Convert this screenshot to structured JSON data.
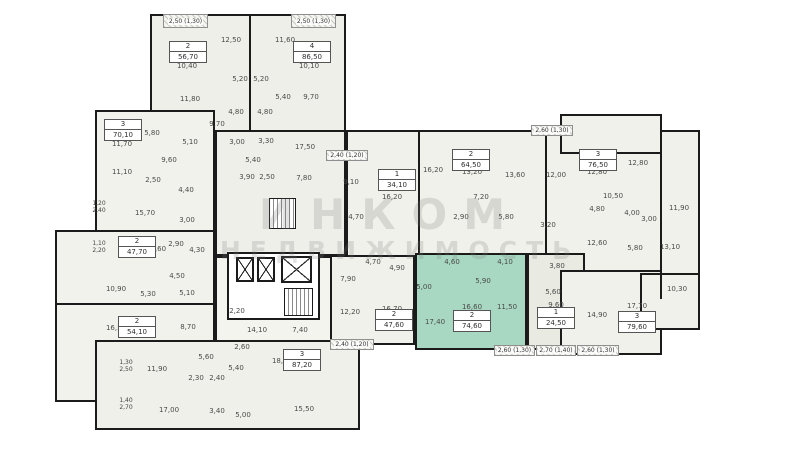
{
  "watermark": {
    "line1": "ИНКОМ",
    "line2": "НЕДВИЖИМОСТЬ"
  },
  "colors": {
    "wall": "#1b1b1b",
    "room_fill": "#f1f1eb",
    "highlight_fill": "#a8d8c2",
    "secondary_fill": "#e9eae2",
    "background": "#ffffff"
  },
  "blocks": [
    {
      "name": "tower-top",
      "x": 150,
      "y": 14,
      "w": 196,
      "h": 120,
      "fill": "#efefe9"
    },
    {
      "name": "tower-mid",
      "x": 215,
      "y": 130,
      "w": 131,
      "h": 126,
      "fill": "#efefe9"
    },
    {
      "name": "left-wing-top",
      "x": 95,
      "y": 110,
      "w": 120,
      "h": 122,
      "fill": "#f2f2ec"
    },
    {
      "name": "left-wing-main",
      "x": 55,
      "y": 230,
      "w": 160,
      "h": 172,
      "fill": "#f2f2ec"
    },
    {
      "name": "corridor-block",
      "x": 215,
      "y": 256,
      "w": 145,
      "h": 89,
      "fill": "#f4f4ef"
    },
    {
      "name": "bottom-block",
      "x": 95,
      "y": 340,
      "w": 265,
      "h": 90,
      "fill": "#eff0e9"
    },
    {
      "name": "mid-band",
      "x": 346,
      "y": 130,
      "w": 354,
      "h": 170,
      "fill": "#f1f1eb"
    },
    {
      "name": "right-top-block",
      "x": 560,
      "y": 114,
      "w": 102,
      "h": 40,
      "fill": "#f1f1eb"
    },
    {
      "name": "unit-4760-block",
      "x": 330,
      "y": 255,
      "w": 85,
      "h": 90,
      "fill": "#f1f1eb"
    },
    {
      "name": "unit-selected-block",
      "x": 415,
      "y": 253,
      "w": 112,
      "h": 97,
      "fill": "#a8d8c2"
    },
    {
      "name": "unit-2450-block",
      "x": 527,
      "y": 253,
      "w": 58,
      "h": 97,
      "fill": "#e9eae2"
    },
    {
      "name": "bottom-right-block",
      "x": 560,
      "y": 270,
      "w": 102,
      "h": 85,
      "fill": "#f1f1eb"
    },
    {
      "name": "bottom-right-protrusion",
      "x": 640,
      "y": 273,
      "w": 60,
      "h": 57,
      "fill": "#f1f1eb"
    },
    {
      "name": "core-block",
      "x": 227,
      "y": 252,
      "w": 93,
      "h": 68,
      "fill": "#ffffff"
    }
  ],
  "walls": [
    {
      "x": 249,
      "y": 14,
      "w": 2,
      "h": 118
    },
    {
      "x": 418,
      "y": 131,
      "w": 2,
      "h": 124
    },
    {
      "x": 545,
      "y": 131,
      "w": 2,
      "h": 124
    },
    {
      "x": 660,
      "y": 131,
      "w": 2,
      "h": 168
    },
    {
      "x": 57,
      "y": 303,
      "w": 158,
      "h": 2
    }
  ],
  "apartments": [
    {
      "rooms": "2",
      "area": "56,70",
      "x": 188,
      "y": 52,
      "selected": false
    },
    {
      "rooms": "4",
      "area": "86,50",
      "x": 312,
      "y": 52,
      "selected": false
    },
    {
      "rooms": "3",
      "area": "70,10",
      "x": 123,
      "y": 130,
      "selected": false
    },
    {
      "rooms": "2",
      "area": "47,70",
      "x": 137,
      "y": 247,
      "selected": false
    },
    {
      "rooms": "2",
      "area": "54,10",
      "x": 137,
      "y": 327,
      "selected": false
    },
    {
      "rooms": "3",
      "area": "87,20",
      "x": 302,
      "y": 360,
      "selected": false
    },
    {
      "rooms": "1",
      "area": "34,10",
      "x": 397,
      "y": 180,
      "selected": false
    },
    {
      "rooms": "2",
      "area": "64,50",
      "x": 471,
      "y": 160,
      "selected": false
    },
    {
      "rooms": "3",
      "area": "76,50",
      "x": 598,
      "y": 160,
      "selected": false
    },
    {
      "rooms": "2",
      "area": "47,60",
      "x": 394,
      "y": 320,
      "selected": false
    },
    {
      "rooms": "2",
      "area": "74,60",
      "x": 472,
      "y": 321,
      "selected": true
    },
    {
      "rooms": "1",
      "area": "24,50",
      "x": 556,
      "y": 318,
      "selected": false
    },
    {
      "rooms": "3",
      "area": "79,60",
      "x": 637,
      "y": 322,
      "selected": false
    }
  ],
  "rooms": [
    {
      "t": "12,50",
      "x": 231,
      "y": 40
    },
    {
      "t": "11,60",
      "x": 285,
      "y": 40
    },
    {
      "t": "10,40",
      "x": 187,
      "y": 66
    },
    {
      "t": "10,10",
      "x": 309,
      "y": 66
    },
    {
      "t": "11,80",
      "x": 190,
      "y": 99
    },
    {
      "t": "5,20",
      "x": 240,
      "y": 79
    },
    {
      "t": "5,20",
      "x": 261,
      "y": 79
    },
    {
      "t": "5,40",
      "x": 283,
      "y": 97
    },
    {
      "t": "9,70",
      "x": 311,
      "y": 97
    },
    {
      "t": "4,80",
      "x": 236,
      "y": 112
    },
    {
      "t": "4,80",
      "x": 265,
      "y": 112
    },
    {
      "t": "9,70",
      "x": 217,
      "y": 124
    },
    {
      "t": "3,00",
      "x": 237,
      "y": 142
    },
    {
      "t": "3,30",
      "x": 266,
      "y": 141
    },
    {
      "t": "17,50",
      "x": 305,
      "y": 147
    },
    {
      "t": "5,40",
      "x": 253,
      "y": 160
    },
    {
      "t": "3,90",
      "x": 247,
      "y": 177
    },
    {
      "t": "2,50",
      "x": 267,
      "y": 177
    },
    {
      "t": "7,80",
      "x": 304,
      "y": 178
    },
    {
      "t": "5,80",
      "x": 152,
      "y": 133
    },
    {
      "t": "11,70",
      "x": 122,
      "y": 144
    },
    {
      "t": "5,10",
      "x": 190,
      "y": 142
    },
    {
      "t": "9,60",
      "x": 169,
      "y": 160
    },
    {
      "t": "11,10",
      "x": 122,
      "y": 172
    },
    {
      "t": "2,50",
      "x": 153,
      "y": 180
    },
    {
      "t": "4,40",
      "x": 186,
      "y": 190
    },
    {
      "t": "15,70",
      "x": 145,
      "y": 213
    },
    {
      "t": "3,00",
      "x": 187,
      "y": 220
    },
    {
      "t": "2,90",
      "x": 176,
      "y": 244
    },
    {
      "t": "13,60",
      "x": 156,
      "y": 249
    },
    {
      "t": "4,30",
      "x": 197,
      "y": 250
    },
    {
      "t": "4,50",
      "x": 177,
      "y": 276
    },
    {
      "t": "10,90",
      "x": 116,
      "y": 289
    },
    {
      "t": "5,30",
      "x": 148,
      "y": 294
    },
    {
      "t": "5,10",
      "x": 187,
      "y": 293
    },
    {
      "t": "16,50",
      "x": 116,
      "y": 328
    },
    {
      "t": "8,70",
      "x": 188,
      "y": 327
    },
    {
      "t": "2,20",
      "x": 237,
      "y": 311
    },
    {
      "t": "14,10",
      "x": 257,
      "y": 330
    },
    {
      "t": "7,40",
      "x": 300,
      "y": 330
    },
    {
      "t": "2,60",
      "x": 242,
      "y": 347
    },
    {
      "t": "5,40",
      "x": 236,
      "y": 368
    },
    {
      "t": "5,60",
      "x": 206,
      "y": 357
    },
    {
      "t": "11,90",
      "x": 157,
      "y": 369
    },
    {
      "t": "2,30",
      "x": 196,
      "y": 378
    },
    {
      "t": "2,40",
      "x": 217,
      "y": 378
    },
    {
      "t": "18,60",
      "x": 282,
      "y": 361
    },
    {
      "t": "17,00",
      "x": 169,
      "y": 410
    },
    {
      "t": "3,40",
      "x": 217,
      "y": 411
    },
    {
      "t": "5,00",
      "x": 243,
      "y": 415
    },
    {
      "t": "15,50",
      "x": 304,
      "y": 409
    },
    {
      "t": "9,10",
      "x": 351,
      "y": 182
    },
    {
      "t": "16,20",
      "x": 392,
      "y": 197
    },
    {
      "t": "4,70",
      "x": 356,
      "y": 217
    },
    {
      "t": "16,20",
      "x": 433,
      "y": 170
    },
    {
      "t": "13,20",
      "x": 472,
      "y": 172
    },
    {
      "t": "13,60",
      "x": 515,
      "y": 175
    },
    {
      "t": "7,20",
      "x": 481,
      "y": 197
    },
    {
      "t": "2,90",
      "x": 461,
      "y": 217
    },
    {
      "t": "5,80",
      "x": 506,
      "y": 217
    },
    {
      "t": "12,00",
      "x": 556,
      "y": 175
    },
    {
      "t": "12,80",
      "x": 597,
      "y": 172
    },
    {
      "t": "12,80",
      "x": 638,
      "y": 163
    },
    {
      "t": "10,50",
      "x": 613,
      "y": 196
    },
    {
      "t": "4,80",
      "x": 597,
      "y": 209
    },
    {
      "t": "4,00",
      "x": 632,
      "y": 213
    },
    {
      "t": "3,00",
      "x": 649,
      "y": 219
    },
    {
      "t": "3,20",
      "x": 548,
      "y": 225
    },
    {
      "t": "11,90",
      "x": 679,
      "y": 208
    },
    {
      "t": "5,80",
      "x": 635,
      "y": 248
    },
    {
      "t": "13,10",
      "x": 670,
      "y": 247
    },
    {
      "t": "12,60",
      "x": 597,
      "y": 243
    },
    {
      "t": "7,90",
      "x": 348,
      "y": 279
    },
    {
      "t": "4,70",
      "x": 373,
      "y": 262
    },
    {
      "t": "4,90",
      "x": 397,
      "y": 268
    },
    {
      "t": "12,20",
      "x": 350,
      "y": 312
    },
    {
      "t": "16,70",
      "x": 392,
      "y": 309
    },
    {
      "t": "4,60",
      "x": 452,
      "y": 262
    },
    {
      "t": "4,10",
      "x": 505,
      "y": 262
    },
    {
      "t": "5,00",
      "x": 424,
      "y": 287
    },
    {
      "t": "5,90",
      "x": 483,
      "y": 281
    },
    {
      "t": "17,40",
      "x": 435,
      "y": 322
    },
    {
      "t": "16,60",
      "x": 472,
      "y": 307
    },
    {
      "t": "11,50",
      "x": 507,
      "y": 307
    },
    {
      "t": "3,80",
      "x": 557,
      "y": 266
    },
    {
      "t": "5,60",
      "x": 553,
      "y": 292
    },
    {
      "t": "9,60",
      "x": 556,
      "y": 305
    },
    {
      "t": "14,90",
      "x": 597,
      "y": 315
    },
    {
      "t": "17,70",
      "x": 637,
      "y": 306
    },
    {
      "t": "10,30",
      "x": 677,
      "y": 289
    }
  ],
  "balconies": [
    {
      "t": "2,50 (1,30)",
      "x": 163,
      "y": 14,
      "w": 45,
      "h": 14
    },
    {
      "t": "2,50 (1,30)",
      "x": 291,
      "y": 14,
      "w": 45,
      "h": 14
    },
    {
      "t": "2,60 (1,30)",
      "x": 531,
      "y": 125,
      "w": 42,
      "h": 11
    },
    {
      "t": "2,40 (1,20)",
      "x": 326,
      "y": 150,
      "w": 42,
      "h": 11
    },
    {
      "t": "2,40 (1,20)",
      "x": 330,
      "y": 339,
      "w": 44,
      "h": 11
    },
    {
      "t": "2,60 (1,30)",
      "x": 494,
      "y": 345,
      "w": 41,
      "h": 11
    },
    {
      "t": "2,70 (1,40)",
      "x": 536,
      "y": 345,
      "w": 40,
      "h": 11
    },
    {
      "t": "2,60 (1,30)",
      "x": 577,
      "y": 345,
      "w": 42,
      "h": 11
    }
  ],
  "edge_labels": [
    {
      "l1": "1,20",
      "l2": "2,40",
      "x": 99,
      "y": 207
    },
    {
      "l1": "1,10",
      "l2": "2,20",
      "x": 99,
      "y": 247
    },
    {
      "l1": "1,30",
      "l2": "2,50",
      "x": 126,
      "y": 366
    },
    {
      "l1": "1,40",
      "l2": "2,70",
      "x": 126,
      "y": 404
    }
  ],
  "core": {
    "elevators": [
      {
        "x": 236,
        "y": 257,
        "w": 18,
        "h": 25
      },
      {
        "x": 257,
        "y": 257,
        "w": 18,
        "h": 25
      },
      {
        "x": 281,
        "y": 256,
        "w": 31,
        "h": 27
      }
    ],
    "stairs": [
      {
        "x": 269,
        "y": 198,
        "w": 27,
        "h": 31
      },
      {
        "x": 284,
        "y": 288,
        "w": 29,
        "h": 28
      }
    ]
  }
}
